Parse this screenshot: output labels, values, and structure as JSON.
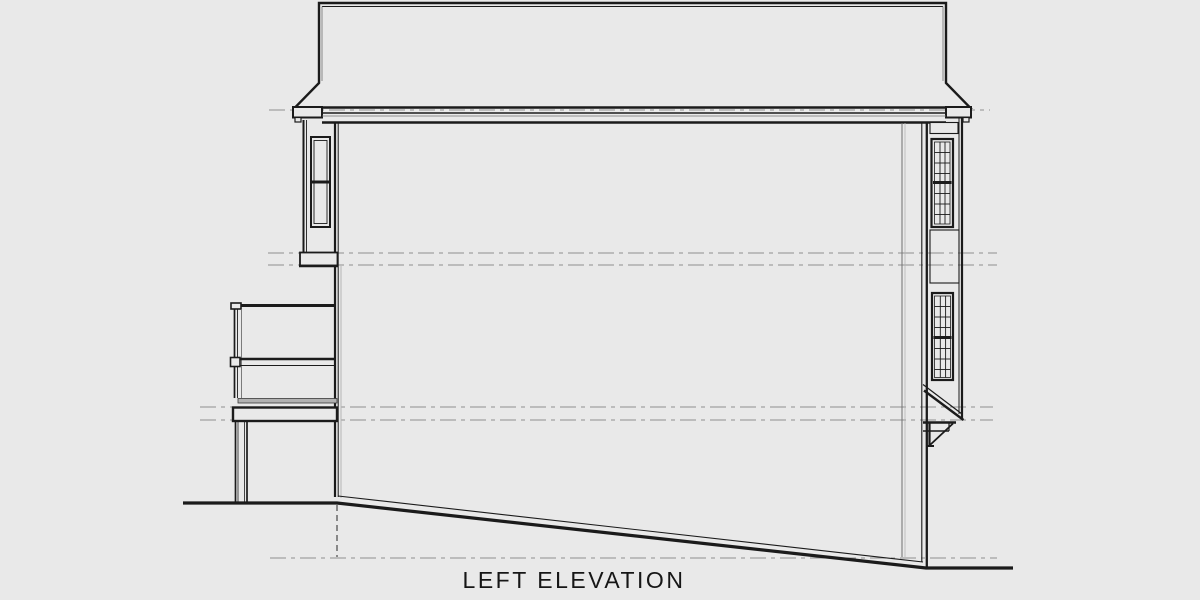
{
  "title": {
    "label": "LEFT ELEVATION"
  },
  "colors": {
    "background": "#e9e9e9",
    "line_dark": "#1b1b1b",
    "line_dark2": "#3a3a3a",
    "line_mid": "#6f6f6f",
    "line_light": "#b5b5b5",
    "datum": "#8f8f8f",
    "deck_fill": "#b2b2b2"
  },
  "shapes": [
    {
      "t": "line",
      "n": "datum-line-roof",
      "x1": 269,
      "y1": 110,
      "x2": 990,
      "y2": 110,
      "w": 1,
      "s": "gray",
      "dash": "16 5 4 5"
    },
    {
      "t": "line",
      "n": "datum-line-upper-a",
      "x1": 268,
      "y1": 253,
      "x2": 997,
      "y2": 253,
      "w": 1,
      "s": "gray",
      "dash": "16 5 4 5"
    },
    {
      "t": "line",
      "n": "datum-line-upper-b",
      "x1": 268,
      "y1": 265,
      "x2": 997,
      "y2": 265,
      "w": 1,
      "s": "gray",
      "dash": "16 5 4 5"
    },
    {
      "t": "line",
      "n": "datum-line-main-a",
      "x1": 200,
      "y1": 407,
      "x2": 993,
      "y2": 407,
      "w": 1,
      "s": "gray",
      "dash": "16 5 4 5"
    },
    {
      "t": "line",
      "n": "datum-line-main-b",
      "x1": 200,
      "y1": 420,
      "x2": 993,
      "y2": 420,
      "w": 1,
      "s": "gray",
      "dash": "16 5 4 5"
    },
    {
      "t": "line",
      "n": "datum-line-ground",
      "x1": 270,
      "y1": 558,
      "x2": 997,
      "y2": 558,
      "w": 1,
      "s": "gray",
      "dash": "16 5 4 5"
    },
    {
      "t": "poly",
      "n": "roof-outline",
      "pts": [
        [
          319,
          3
        ],
        [
          946,
          3
        ],
        [
          946,
          83
        ],
        [
          970,
          107.5
        ],
        [
          295,
          107.5
        ],
        [
          319,
          83
        ]
      ],
      "closed": true,
      "sw": 2.4,
      "s": "dark",
      "f": "bg"
    },
    {
      "t": "line",
      "n": "roof-inner-top",
      "x1": 322,
      "y1": 6.5,
      "x2": 943,
      "y2": 6.5,
      "w": 1,
      "s": "dark"
    },
    {
      "t": "line",
      "n": "roof-inner-left",
      "x1": 322,
      "y1": 6.5,
      "x2": 322,
      "y2": 81,
      "w": 0.8,
      "s": "mid"
    },
    {
      "t": "line",
      "n": "roof-inner-right",
      "x1": 943,
      "y1": 6.5,
      "x2": 943,
      "y2": 81,
      "w": 0.8,
      "s": "mid"
    },
    {
      "t": "rect",
      "n": "eave-left",
      "x": 293,
      "y": 107,
      "w": 29,
      "h": 10.5,
      "sw": 2,
      "s": "dark",
      "f": "bg"
    },
    {
      "t": "rect",
      "n": "eave-left-return",
      "x": 295,
      "y": 117.5,
      "w": 6,
      "h": 4.5,
      "sw": 1.2,
      "s": "dark",
      "f": "bg"
    },
    {
      "t": "rect",
      "n": "eave-right",
      "x": 946,
      "y": 107,
      "w": 25,
      "h": 10.5,
      "sw": 2,
      "s": "dark",
      "f": "bg"
    },
    {
      "t": "rect",
      "n": "eave-right-return",
      "x": 963,
      "y": 117.5,
      "w": 6,
      "h": 4.5,
      "sw": 1.2,
      "s": "dark",
      "f": "bg"
    },
    {
      "t": "line",
      "n": "fascia-top",
      "x1": 322,
      "y1": 113,
      "x2": 946,
      "y2": 113,
      "w": 1.4,
      "s": "dark"
    },
    {
      "t": "line",
      "n": "fascia-mid",
      "x1": 322,
      "y1": 116,
      "x2": 946,
      "y2": 116,
      "w": 0.8,
      "s": "mid"
    },
    {
      "t": "line",
      "n": "fascia-bottom",
      "x1": 322,
      "y1": 122.5,
      "x2": 946,
      "y2": 122.5,
      "w": 2.4,
      "s": "dark"
    },
    {
      "t": "line",
      "n": "wall-left-outer",
      "x1": 335,
      "y1": 122,
      "x2": 335,
      "y2": 497,
      "w": 2.2,
      "s": "dark"
    },
    {
      "t": "line",
      "n": "wall-left-inner",
      "x1": 338.2,
      "y1": 122,
      "x2": 338.2,
      "y2": 497,
      "w": 1,
      "s": "dark"
    },
    {
      "t": "line",
      "n": "wall-left-shadow",
      "x1": 341,
      "y1": 266,
      "x2": 341,
      "y2": 498,
      "w": 1,
      "s": "light"
    },
    {
      "t": "line",
      "n": "wall-interior-a",
      "x1": 902,
      "y1": 123,
      "x2": 902,
      "y2": 557,
      "w": 1,
      "s": "mid"
    },
    {
      "t": "line",
      "n": "wall-interior-b",
      "x1": 905,
      "y1": 123,
      "x2": 905,
      "y2": 557,
      "w": 0.8,
      "s": "light"
    },
    {
      "t": "line",
      "n": "wall-right-inner",
      "x1": 921.8,
      "y1": 122,
      "x2": 921.8,
      "y2": 562,
      "w": 1.1,
      "s": "dark"
    },
    {
      "t": "line",
      "n": "wall-right-outer",
      "x1": 926.8,
      "y1": 122,
      "x2": 926.8,
      "y2": 569,
      "w": 2.3,
      "s": "dark"
    },
    {
      "t": "line",
      "n": "wall-bottom-edge",
      "x1": 338,
      "y1": 496,
      "x2": 923,
      "y2": 562,
      "w": 1.1,
      "s": "dark"
    },
    {
      "t": "poly",
      "n": "grade-line",
      "pts": [
        [
          183,
          503
        ],
        [
          337,
          503
        ],
        [
          926,
          568
        ],
        [
          1013,
          568
        ]
      ],
      "closed": false,
      "sw": 3.2,
      "s": "dark",
      "f": "none"
    },
    {
      "t": "line",
      "n": "foundation-hidden-line",
      "x1": 337,
      "y1": 505,
      "x2": 337,
      "y2": 557,
      "w": 1.1,
      "s": "dark2",
      "dash": "6 4"
    },
    {
      "t": "line",
      "n": "left-bay-wall-outer",
      "x1": 303.5,
      "y1": 120,
      "x2": 303.5,
      "y2": 252,
      "w": 2,
      "s": "dark"
    },
    {
      "t": "line",
      "n": "left-bay-wall-inner",
      "x1": 306.5,
      "y1": 120,
      "x2": 306.5,
      "y2": 252,
      "w": 0.9,
      "s": "dark"
    },
    {
      "t": "rect",
      "n": "left-window-frame",
      "x": 311,
      "y": 137,
      "w": 19,
      "h": 90,
      "sw": 2,
      "s": "dark",
      "f": "bg"
    },
    {
      "t": "rect",
      "n": "left-window-inner-frame",
      "x": 314,
      "y": 140.5,
      "w": 13,
      "h": 83,
      "sw": 0.9,
      "s": "dark",
      "f": "none"
    },
    {
      "t": "line",
      "n": "left-window-midrail",
      "x1": 312,
      "y1": 182,
      "x2": 329,
      "y2": 182,
      "w": 3,
      "s": "dark"
    },
    {
      "t": "rect",
      "n": "left-bay-base",
      "x": 300,
      "y": 252.5,
      "w": 37.5,
      "h": 13,
      "sw": 1.8,
      "s": "dark",
      "f": "bg"
    },
    {
      "t": "line",
      "n": "left-bay-base-bottom",
      "x1": 299,
      "y1": 266,
      "x2": 338,
      "y2": 266,
      "w": 2.4,
      "s": "dark"
    },
    {
      "t": "line",
      "n": "deck-top-rail",
      "x1": 232,
      "y1": 305.5,
      "x2": 336,
      "y2": 305.5,
      "w": 3,
      "s": "dark"
    },
    {
      "t": "rect",
      "n": "deck-top-rail-cap",
      "x": 231,
      "y": 303,
      "w": 10,
      "h": 6,
      "sw": 1.6,
      "s": "dark",
      "f": "bg"
    },
    {
      "t": "line",
      "n": "deck-rail-post-a",
      "x1": 234.5,
      "y1": 309,
      "x2": 234.5,
      "y2": 398,
      "w": 1.7,
      "s": "dark"
    },
    {
      "t": "line",
      "n": "deck-rail-post-b",
      "x1": 237.5,
      "y1": 309,
      "x2": 237.5,
      "y2": 398,
      "w": 0.9,
      "s": "dark"
    },
    {
      "t": "line",
      "n": "deck-rail-post-c",
      "x1": 241.5,
      "y1": 309,
      "x2": 241.5,
      "y2": 398,
      "w": 0.9,
      "s": "mid"
    },
    {
      "t": "line",
      "n": "deck-mid-rail-top",
      "x1": 231,
      "y1": 359,
      "x2": 336,
      "y2": 359,
      "w": 2.6,
      "s": "dark"
    },
    {
      "t": "line",
      "n": "deck-mid-rail-bottom",
      "x1": 231,
      "y1": 365.5,
      "x2": 336,
      "y2": 365.5,
      "w": 1.1,
      "s": "dark"
    },
    {
      "t": "rect",
      "n": "deck-mid-rail-cap",
      "x": 230.5,
      "y": 357.5,
      "w": 9.5,
      "h": 9,
      "sw": 1.6,
      "s": "dark",
      "f": "bg"
    },
    {
      "t": "rect",
      "n": "deck-floor-band",
      "x": 238,
      "y": 398.5,
      "w": 99,
      "h": 4.5,
      "sw": 0.8,
      "s": "dark2",
      "f": "deck"
    },
    {
      "t": "rect",
      "n": "deck-rim-joist",
      "x": 233,
      "y": 407.5,
      "w": 104,
      "h": 13.5,
      "sw": 2.4,
      "s": "dark",
      "f": "bg"
    },
    {
      "t": "line",
      "n": "deck-support-post-a",
      "x1": 235.5,
      "y1": 421,
      "x2": 235.5,
      "y2": 502,
      "w": 1.7,
      "s": "dark"
    },
    {
      "t": "line",
      "n": "deck-support-post-b",
      "x1": 238,
      "y1": 421,
      "x2": 238,
      "y2": 502,
      "w": 0.8,
      "s": "dark"
    },
    {
      "t": "line",
      "n": "deck-support-post-c",
      "x1": 244.5,
      "y1": 421,
      "x2": 244.5,
      "y2": 502,
      "w": 0.8,
      "s": "dark"
    },
    {
      "t": "line",
      "n": "deck-support-post-d",
      "x1": 247,
      "y1": 421,
      "x2": 247,
      "y2": 502,
      "w": 1.7,
      "s": "dark"
    },
    {
      "t": "line",
      "n": "right-bay-wall-inner",
      "x1": 959,
      "y1": 118,
      "x2": 959,
      "y2": 414,
      "w": 1,
      "s": "dark"
    },
    {
      "t": "line",
      "n": "right-bay-wall-outer",
      "x1": 962,
      "y1": 118,
      "x2": 962,
      "y2": 418,
      "w": 2.2,
      "s": "dark"
    },
    {
      "t": "rect",
      "n": "right-bay-top-panel",
      "x": 930,
      "y": 122.5,
      "w": 28,
      "h": 11,
      "sw": 1.1,
      "s": "dark",
      "f": "bg"
    },
    {
      "t": "rect",
      "n": "right-upper-window-frame",
      "x": 931.5,
      "y": 139,
      "w": 21.5,
      "h": 88,
      "sw": 2.2,
      "s": "dark",
      "f": "bg"
    },
    {
      "t": "rect",
      "n": "right-upper-window-inner",
      "x": 934.5,
      "y": 142,
      "w": 15.5,
      "h": 82,
      "sw": 0.8,
      "s": "dark",
      "f": "none"
    },
    {
      "t": "line",
      "n": "right-upper-window-mullion-a",
      "x1": 940,
      "y1": 142,
      "x2": 940,
      "y2": 224,
      "w": 0.9,
      "s": "dark"
    },
    {
      "t": "line",
      "n": "right-upper-window-mullion-b",
      "x1": 945,
      "y1": 142,
      "x2": 945,
      "y2": 224,
      "w": 0.9,
      "s": "dark"
    },
    {
      "t": "line",
      "n": "right-upper-window-bar-1",
      "x1": 934.5,
      "y1": 152.5,
      "x2": 950,
      "y2": 152.5,
      "w": 0.9,
      "s": "dark"
    },
    {
      "t": "line",
      "n": "right-upper-window-bar-2",
      "x1": 934.5,
      "y1": 163,
      "x2": 950,
      "y2": 163,
      "w": 0.9,
      "s": "dark"
    },
    {
      "t": "line",
      "n": "right-upper-window-bar-3",
      "x1": 934.5,
      "y1": 173.5,
      "x2": 950,
      "y2": 173.5,
      "w": 0.9,
      "s": "dark"
    },
    {
      "t": "line",
      "n": "right-upper-window-midrail",
      "x1": 933,
      "y1": 182.5,
      "x2": 951.5,
      "y2": 182.5,
      "w": 3,
      "s": "dark"
    },
    {
      "t": "line",
      "n": "right-upper-window-bar-4",
      "x1": 934.5,
      "y1": 193.5,
      "x2": 950,
      "y2": 193.5,
      "w": 0.9,
      "s": "dark"
    },
    {
      "t": "line",
      "n": "right-upper-window-bar-5",
      "x1": 934.5,
      "y1": 204,
      "x2": 950,
      "y2": 204,
      "w": 0.9,
      "s": "dark"
    },
    {
      "t": "line",
      "n": "right-upper-window-bar-6",
      "x1": 934.5,
      "y1": 214.5,
      "x2": 950,
      "y2": 214.5,
      "w": 0.9,
      "s": "dark"
    },
    {
      "t": "rect",
      "n": "right-bay-mid-panel",
      "x": 930,
      "y": 230,
      "w": 29,
      "h": 53,
      "sw": 1.1,
      "s": "dark",
      "f": "none"
    },
    {
      "t": "rect",
      "n": "right-lower-window-frame",
      "x": 932,
      "y": 293,
      "w": 21,
      "h": 87,
      "sw": 2.2,
      "s": "dark",
      "f": "bg"
    },
    {
      "t": "rect",
      "n": "right-lower-window-inner",
      "x": 934.5,
      "y": 296,
      "w": 16,
      "h": 81.5,
      "sw": 0.8,
      "s": "dark",
      "f": "none"
    },
    {
      "t": "line",
      "n": "right-lower-window-mullion-a",
      "x1": 940.3,
      "y1": 296,
      "x2": 940.3,
      "y2": 377.5,
      "w": 0.9,
      "s": "dark"
    },
    {
      "t": "line",
      "n": "right-lower-window-mullion-b",
      "x1": 945.6,
      "y1": 296,
      "x2": 945.6,
      "y2": 377.5,
      "w": 0.9,
      "s": "dark"
    },
    {
      "t": "line",
      "n": "right-lower-window-bar-1",
      "x1": 934.5,
      "y1": 306.5,
      "x2": 950.5,
      "y2": 306.5,
      "w": 0.9,
      "s": "dark"
    },
    {
      "t": "line",
      "n": "right-lower-window-bar-2",
      "x1": 934.5,
      "y1": 317,
      "x2": 950.5,
      "y2": 317,
      "w": 0.9,
      "s": "dark"
    },
    {
      "t": "line",
      "n": "right-lower-window-bar-3",
      "x1": 934.5,
      "y1": 327.5,
      "x2": 950.5,
      "y2": 327.5,
      "w": 0.9,
      "s": "dark"
    },
    {
      "t": "line",
      "n": "right-lower-window-midrail",
      "x1": 933.5,
      "y1": 337.5,
      "x2": 951.5,
      "y2": 337.5,
      "w": 3,
      "s": "dark"
    },
    {
      "t": "line",
      "n": "right-lower-window-bar-4",
      "x1": 934.5,
      "y1": 348.5,
      "x2": 950.5,
      "y2": 348.5,
      "w": 0.9,
      "s": "dark"
    },
    {
      "t": "line",
      "n": "right-lower-window-bar-5",
      "x1": 934.5,
      "y1": 359,
      "x2": 950.5,
      "y2": 359,
      "w": 0.9,
      "s": "dark"
    },
    {
      "t": "line",
      "n": "right-lower-window-bar-6",
      "x1": 934.5,
      "y1": 369.5,
      "x2": 950.5,
      "y2": 369.5,
      "w": 0.9,
      "s": "dark"
    },
    {
      "t": "line",
      "n": "bay-underside-slope-top",
      "x1": 923,
      "y1": 384.5,
      "x2": 962,
      "y2": 414,
      "w": 1.2,
      "s": "dark"
    },
    {
      "t": "line",
      "n": "bay-underside-slope-bottom",
      "x1": 924,
      "y1": 390.5,
      "x2": 963.5,
      "y2": 420,
      "w": 2.4,
      "s": "dark"
    },
    {
      "t": "line",
      "n": "bay-bottom-band",
      "x1": 923,
      "y1": 422.5,
      "x2": 956,
      "y2": 422.5,
      "w": 2.6,
      "s": "dark"
    },
    {
      "t": "line",
      "n": "bay-bottom-step",
      "x1": 923,
      "y1": 431,
      "x2": 949,
      "y2": 431,
      "w": 1.4,
      "s": "dark"
    },
    {
      "t": "line",
      "n": "bay-bottom-step-side",
      "x1": 949,
      "y1": 423,
      "x2": 949,
      "y2": 431,
      "w": 1.2,
      "s": "dark"
    },
    {
      "t": "line",
      "n": "bay-bracket-vertical",
      "x1": 929.5,
      "y1": 423,
      "x2": 929.5,
      "y2": 446,
      "w": 2.2,
      "s": "dark"
    },
    {
      "t": "line",
      "n": "bay-bracket-brace",
      "x1": 930,
      "y1": 445,
      "x2": 953,
      "y2": 423.5,
      "w": 1.8,
      "s": "dark"
    },
    {
      "t": "line",
      "n": "bay-bracket-foot",
      "x1": 926,
      "y1": 446,
      "x2": 934,
      "y2": 446,
      "w": 2,
      "s": "dark"
    }
  ]
}
